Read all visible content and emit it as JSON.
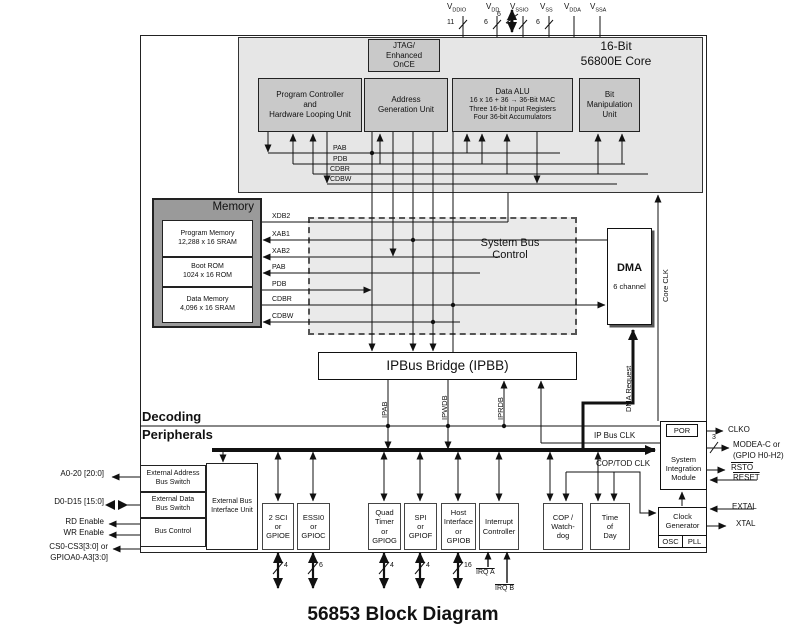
{
  "title": "56853 Block Diagram",
  "colors": {
    "core_fill": "#e6e6e6",
    "unit_fill": "#c9c9c9",
    "memory_fill": "#9a9a9a",
    "sbc_fill": "#eaeaea",
    "line": "#111111"
  },
  "power_pins": [
    {
      "base": "V",
      "sub": "DDIO",
      "count": "11"
    },
    {
      "base": "V",
      "sub": "DD",
      "count": "6"
    },
    {
      "base": "V",
      "sub": "SSIO",
      "count": "10"
    },
    {
      "base": "V",
      "sub": "SS",
      "count": "6"
    },
    {
      "base": "V",
      "sub": "DDA",
      "count": ""
    },
    {
      "base": "V",
      "sub": "SSA",
      "count": ""
    }
  ],
  "jtag_width": "6",
  "core": {
    "title": [
      "16-Bit",
      "56800E Core"
    ],
    "jtag": [
      "JTAG/",
      "Enhanced",
      "OnCE"
    ],
    "units": [
      {
        "lines": [
          "Program Controller",
          "and",
          "Hardware Looping Unit"
        ]
      },
      {
        "lines": [
          "Address",
          "Generation Unit"
        ]
      },
      {
        "lines": [
          "Data ALU",
          "16 x 16 + 36 → 36-Bit MAC",
          "Three 16-bit Input Registers",
          "Four 36-bit Accumulators"
        ]
      },
      {
        "lines": [
          "Bit",
          "Manipulation",
          "Unit"
        ]
      }
    ],
    "buses": [
      "PAB",
      "PDB",
      "CDBR",
      "CDBW"
    ]
  },
  "memory": {
    "title": "Memory",
    "blocks": [
      {
        "lines": [
          "Program Memory",
          "12,288 x 16 SRAM"
        ]
      },
      {
        "lines": [
          "Boot ROM",
          "1024 x 16 ROM"
        ]
      },
      {
        "lines": [
          "Data Memory",
          "4,096 x 16 SRAM"
        ]
      }
    ],
    "buses": [
      "XDB2",
      "XAB1",
      "XAB2",
      "PAB",
      "PDB",
      "CDBR",
      "CDBW"
    ]
  },
  "sbc": [
    "System Bus",
    "Control"
  ],
  "dma": {
    "title": "DMA",
    "sub": "6 channel",
    "request": "DMA Request"
  },
  "core_clk": "Core CLK",
  "ipbb": {
    "title": "IPBus Bridge (IPBB)",
    "buses": [
      "IPAB",
      "IPWDB",
      "IPRDB"
    ],
    "clk": "IP Bus CLK"
  },
  "sections": {
    "decoding": "Decoding",
    "peripherals": "Peripherals"
  },
  "sim": {
    "por": "POR",
    "lines": [
      "System",
      "Integration",
      "Module"
    ]
  },
  "clock_gen": {
    "lines": [
      "Clock",
      "Generator"
    ],
    "osc": "OSC",
    "pll": "PLL",
    "cop_tod_clk": "COP/TOD CLK"
  },
  "right_signals": {
    "clko": "CLKO",
    "mode_width": "3",
    "mode": [
      "MODEA-C or",
      "(GPIO H0-H2)"
    ],
    "rsto": "RSTO",
    "reset": "RESET",
    "extal": "EXTAL",
    "xtal": "XTAL"
  },
  "left_signals": {
    "addr": "A0-20 [20:0]",
    "data": "D0-D15 [15:0]",
    "rd": "RD Enable",
    "wr": "WR Enable",
    "cs": [
      "CS0-CS3[3:0] or",
      "GPIOA0-A3[3:0]"
    ]
  },
  "ebiu": {
    "switches": [
      {
        "lines": [
          "External Address",
          "Bus Switch"
        ]
      },
      {
        "lines": [
          "External Data",
          "Bus Switch"
        ]
      },
      {
        "lines": [
          "Bus Control"
        ]
      }
    ],
    "unit": [
      "External Bus",
      "Interface Unit"
    ]
  },
  "peripherals": [
    {
      "lines": [
        "2 SCI",
        "or",
        "GPIOE"
      ],
      "pins": "4"
    },
    {
      "lines": [
        "ESSI0",
        "or",
        "GPIOC"
      ],
      "pins": "6"
    },
    {
      "lines": [
        "Quad",
        "Timer",
        "or",
        "GPIOG"
      ],
      "pins": "4"
    },
    {
      "lines": [
        "SPI",
        "or",
        "GPIOF"
      ],
      "pins": "4"
    },
    {
      "lines": [
        "Host",
        "Interface",
        "or",
        "GPIOB"
      ],
      "pins": "16"
    },
    {
      "lines": [
        "Interrupt",
        "Controller"
      ],
      "pins": ""
    }
  ],
  "cop": {
    "lines": [
      "COP /",
      "Watch-",
      "dog"
    ]
  },
  "tod": {
    "lines": [
      "Time",
      "of",
      "Day"
    ]
  },
  "irq": [
    "IRQ A",
    "IRQ B"
  ]
}
